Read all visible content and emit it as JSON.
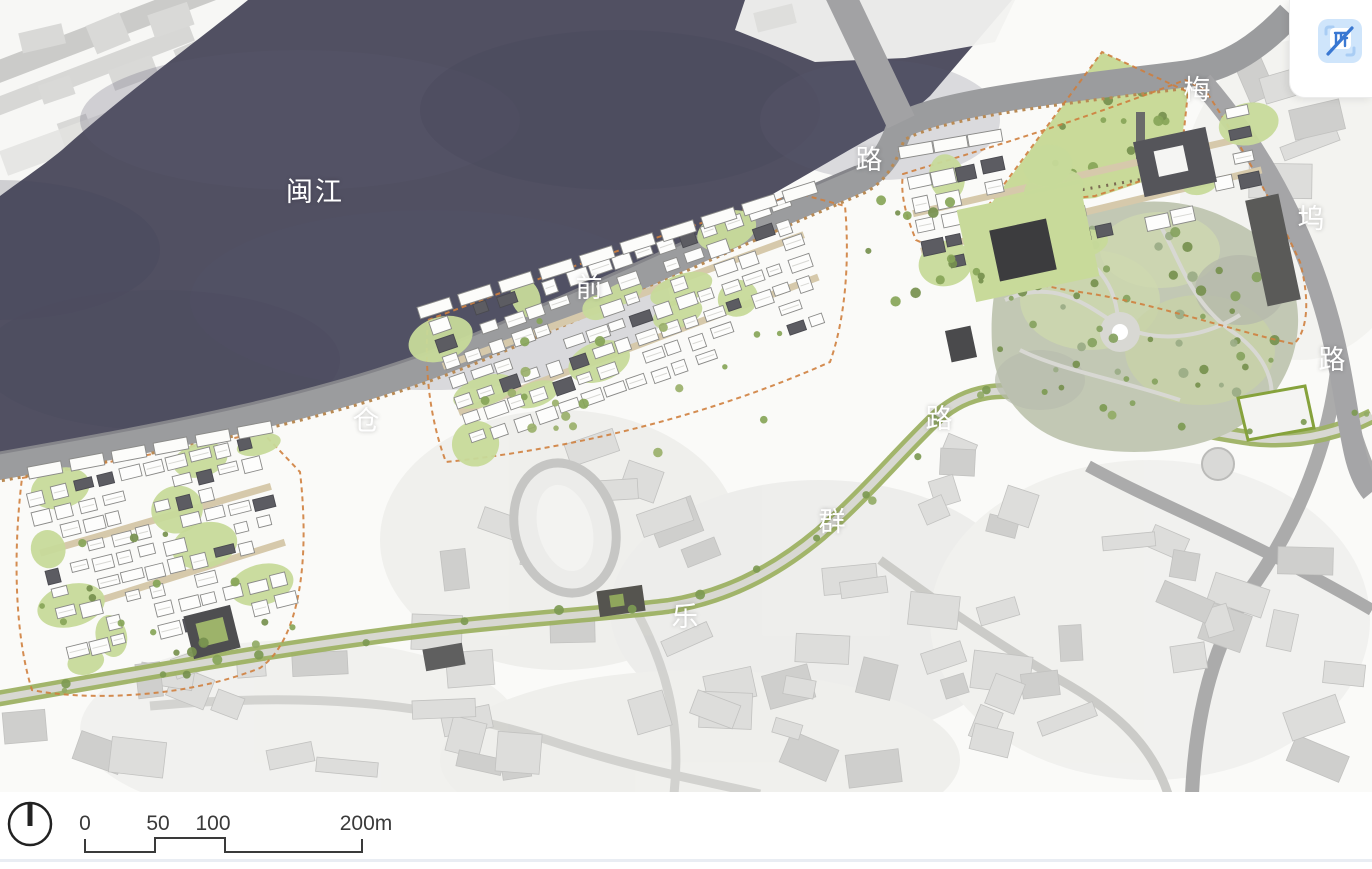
{
  "map": {
    "river_label": "闽江",
    "roads": {
      "cangqian": {
        "name": "仓前路",
        "chars": [
          "仓",
          "前",
          "路"
        ]
      },
      "meiwu": {
        "name": "梅坞路",
        "chars": [
          "梅",
          "坞",
          "路"
        ]
      },
      "lequn": {
        "name": "乐群路",
        "chars": [
          "乐",
          "群",
          "路"
        ]
      }
    }
  },
  "scale_bar": {
    "labels": [
      "0",
      "50",
      "100",
      "200m"
    ]
  },
  "icons": {
    "north_arrow": "north-arrow-icon",
    "translate_button": "image-translate-disabled-icon"
  },
  "colors": {
    "river": "#515062",
    "embankment": "#9b9c9e",
    "lawn": "#c9db9b",
    "tree": "#7d9a52",
    "green_road": "#9db163",
    "context_building": "#dcdcda",
    "site_building": "#fdfdfc",
    "dark_building": "#5c5c62",
    "boundary_dash": "#cf7f3e",
    "accent_blue": "#3a78d2",
    "icon_bg": "#cfe5fb"
  }
}
